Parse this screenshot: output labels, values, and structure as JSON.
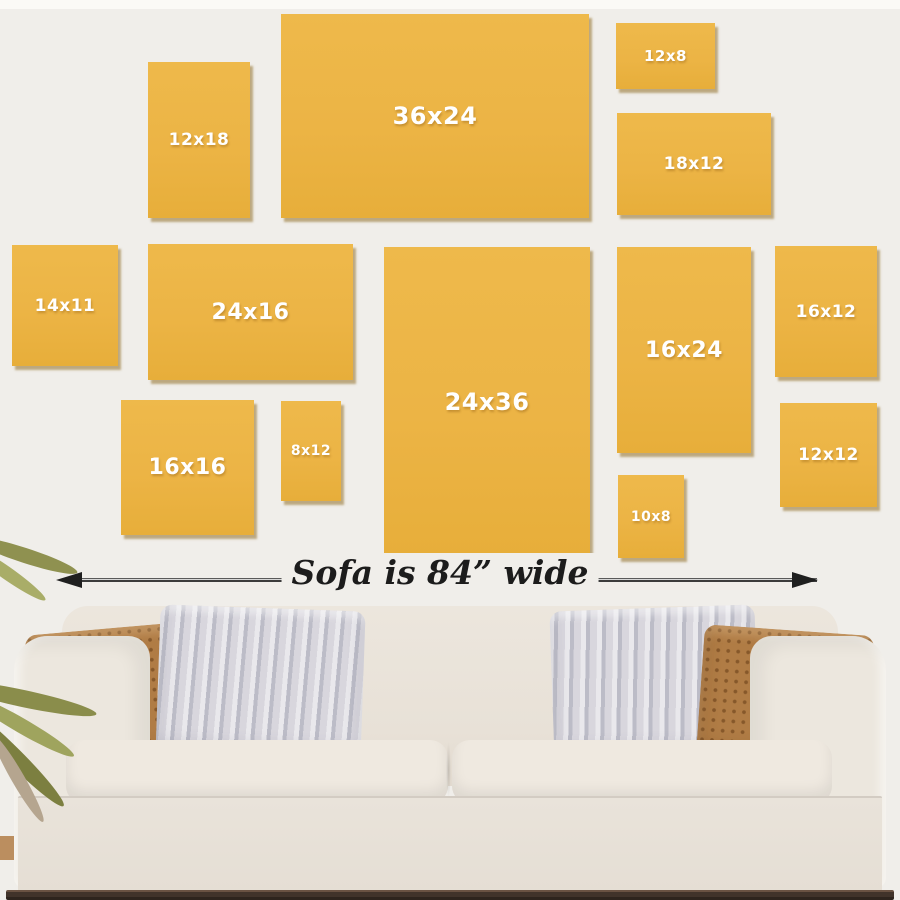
{
  "scene": {
    "description": "Wall art size guide above a sofa",
    "background_color": "#f0eeea",
    "frame_color": "#ecb445",
    "frame_text_color": "#ffffff",
    "sofa_label": "Sofa is 84” wide",
    "arrow_color": "#1f1f1f"
  },
  "frames": [
    {
      "label": "12x18",
      "x": 148,
      "y": 62,
      "w": 102,
      "h": 156,
      "font_px": 17
    },
    {
      "label": "36x24",
      "x": 281,
      "y": 14,
      "w": 308,
      "h": 204,
      "font_px": 24
    },
    {
      "label": "12x8",
      "x": 616,
      "y": 23,
      "w": 99,
      "h": 66,
      "font_px": 15
    },
    {
      "label": "18x12",
      "x": 617,
      "y": 113,
      "w": 154,
      "h": 102,
      "font_px": 17
    },
    {
      "label": "14x11",
      "x": 12,
      "y": 245,
      "w": 106,
      "h": 121,
      "font_px": 17
    },
    {
      "label": "24x16",
      "x": 148,
      "y": 244,
      "w": 205,
      "h": 136,
      "font_px": 22
    },
    {
      "label": "24x36",
      "x": 384,
      "y": 247,
      "w": 206,
      "h": 310,
      "font_px": 24
    },
    {
      "label": "16x24",
      "x": 617,
      "y": 247,
      "w": 134,
      "h": 206,
      "font_px": 22
    },
    {
      "label": "16x12",
      "x": 775,
      "y": 246,
      "w": 102,
      "h": 131,
      "font_px": 17
    },
    {
      "label": "16x16",
      "x": 121,
      "y": 400,
      "w": 133,
      "h": 135,
      "font_px": 22
    },
    {
      "label": "8x12",
      "x": 281,
      "y": 401,
      "w": 60,
      "h": 100,
      "font_px": 14
    },
    {
      "label": "10x8",
      "x": 618,
      "y": 475,
      "w": 66,
      "h": 83,
      "font_px": 14
    },
    {
      "label": "12x12",
      "x": 780,
      "y": 403,
      "w": 97,
      "h": 104,
      "font_px": 17
    }
  ]
}
